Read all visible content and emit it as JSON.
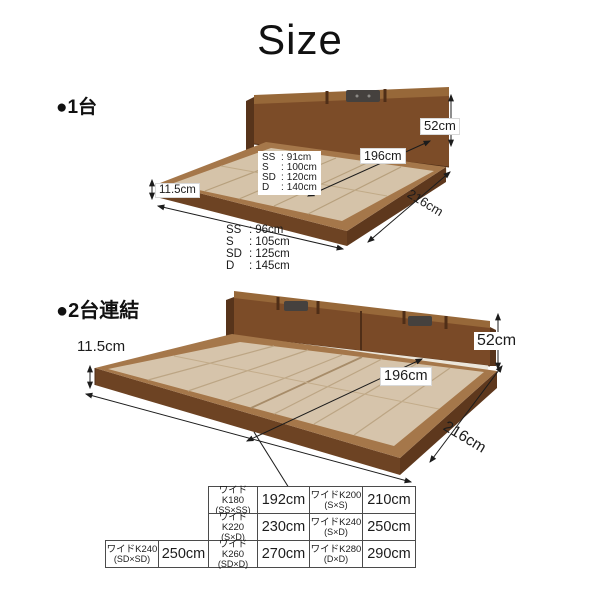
{
  "title": "Size",
  "colors": {
    "headboard": "#7c4c28",
    "headboard_top": "#976839",
    "headboard_side": "#57341b",
    "frame_top": "#a5774a",
    "frame_front": "#6d4323",
    "frame_side": "#5e381d",
    "board": "#d5c3a9",
    "board_line": "#b7a07d",
    "outlet": "#45413e",
    "text": "#1c1c1c",
    "table_border": "#4b4b4b"
  },
  "section1": {
    "heading": "●1台",
    "labels": {
      "headboard_height": "52cm",
      "inner_length": "196cm",
      "outer_length": "216cm",
      "frame_height": "11.5cm"
    },
    "inner_widths": {
      "rows": [
        [
          "SS",
          "91cm"
        ],
        [
          "S",
          "100cm"
        ],
        [
          "SD",
          "120cm"
        ],
        [
          "D",
          "140cm"
        ]
      ]
    },
    "outer_widths": {
      "rows": [
        [
          "SS",
          "96cm"
        ],
        [
          "S",
          "105cm"
        ],
        [
          "SD",
          "125cm"
        ],
        [
          "D",
          "145cm"
        ]
      ]
    }
  },
  "section2": {
    "heading": "●2台連結",
    "labels": {
      "headboard_height": "52cm",
      "inner_length": "196cm",
      "outer_length": "216cm",
      "frame_height": "11.5cm"
    }
  },
  "conversion_table": {
    "rows": [
      {
        "start_col": 2,
        "cells": [
          {
            "name": "ワイドK180",
            "combo": "(SS×SS)"
          },
          {
            "value": "192cm"
          },
          {
            "name": "ワイドK200",
            "combo": "(S×S)"
          },
          {
            "value": "210cm"
          }
        ]
      },
      {
        "start_col": 2,
        "cells": [
          {
            "name": "ワイドK220",
            "combo": "(S×D)"
          },
          {
            "value": "230cm"
          },
          {
            "name": "ワイドK240",
            "combo": "(S×D)"
          },
          {
            "value": "250cm"
          }
        ]
      },
      {
        "start_col": 0,
        "cells": [
          {
            "name": "ワイドK240",
            "combo": "(SD×SD)"
          },
          {
            "value": "250cm"
          },
          {
            "name": "ワイドK260",
            "combo": "(SD×D)"
          },
          {
            "value": "270cm"
          },
          {
            "name": "ワイドK280",
            "combo": "(D×D)"
          },
          {
            "value": "290cm"
          }
        ]
      }
    ]
  }
}
